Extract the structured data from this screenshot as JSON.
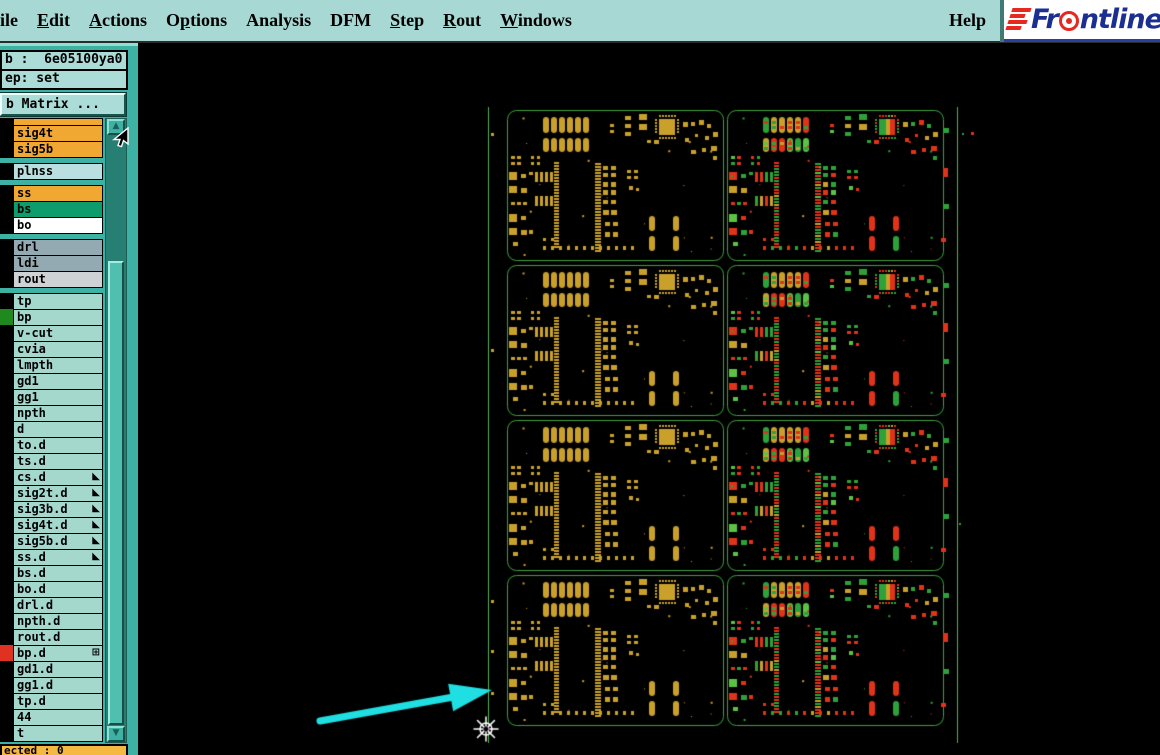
{
  "menubar": {
    "items": [
      {
        "label": "ile",
        "u": -1
      },
      {
        "label": "Edit",
        "u": 0
      },
      {
        "label": "Actions",
        "u": 0
      },
      {
        "label": "Options",
        "u": 1
      },
      {
        "label": "Analysis",
        "u": -1
      },
      {
        "label": "DFM",
        "u": -1
      },
      {
        "label": "Step",
        "u": 0
      },
      {
        "label": "Rout",
        "u": 0
      },
      {
        "label": "Windows",
        "u": 0
      }
    ],
    "help": {
      "label": "Help"
    },
    "logo": {
      "prefix": "Fr",
      "suffix": "ntline",
      "text_color": "#1b2f91",
      "accent_color": "#e8281e",
      "bar_count": 4
    }
  },
  "sidebar": {
    "job_label": "b :  6e05100ya0",
    "step_label": "ep: set",
    "matrix_button_label": "b Matrix ...",
    "selected_label": "ected : 0",
    "layers": [
      {
        "name": "",
        "bg": "#f0a832",
        "partial": true
      },
      {
        "name": "sig4t",
        "bg": "#f0a832"
      },
      {
        "name": "sig5b",
        "bg": "#f0a832"
      },
      {
        "name": "plnss",
        "bg": "#b9dfe0",
        "gap": true
      },
      {
        "name": "ss",
        "bg": "#f0a832",
        "gap": true
      },
      {
        "name": "bs",
        "bg": "#0d9d6d"
      },
      {
        "name": "bo",
        "bg": "#ffffff"
      },
      {
        "name": "drl",
        "bg": "#94aab2",
        "gap": true
      },
      {
        "name": "ldi",
        "bg": "#94aab2"
      },
      {
        "name": "rout",
        "bg": "#cfd2d4"
      },
      {
        "name": "tp",
        "bg": "#a5d8cd",
        "gap": true
      },
      {
        "name": "bp",
        "bg": "#a5d8cd",
        "swatch": "#1e8a1e"
      },
      {
        "name": "v-cut",
        "bg": "#a5d8cd"
      },
      {
        "name": "cvia",
        "bg": "#a5d8cd"
      },
      {
        "name": "lmpth",
        "bg": "#a5d8cd"
      },
      {
        "name": "gd1",
        "bg": "#a5d8cd"
      },
      {
        "name": "gg1",
        "bg": "#a5d8cd"
      },
      {
        "name": "npth",
        "bg": "#a5d8cd"
      },
      {
        "name": "d",
        "bg": "#a5d8cd"
      },
      {
        "name": "to.d",
        "bg": "#a5d8cd"
      },
      {
        "name": "ts.d",
        "bg": "#a5d8cd"
      },
      {
        "name": "cs.d",
        "bg": "#a5d8cd",
        "marker": "flag"
      },
      {
        "name": "sig2t.d",
        "bg": "#a5d8cd",
        "marker": "flag"
      },
      {
        "name": "sig3b.d",
        "bg": "#a5d8cd",
        "marker": "flag"
      },
      {
        "name": "sig4t.d",
        "bg": "#a5d8cd",
        "marker": "flag"
      },
      {
        "name": "sig5b.d",
        "bg": "#a5d8cd",
        "marker": "flag"
      },
      {
        "name": "ss.d",
        "bg": "#a5d8cd",
        "marker": "flag"
      },
      {
        "name": "bs.d",
        "bg": "#a5d8cd"
      },
      {
        "name": "bo.d",
        "bg": "#a5d8cd"
      },
      {
        "name": "drl.d",
        "bg": "#a5d8cd"
      },
      {
        "name": "npth.d",
        "bg": "#a5d8cd"
      },
      {
        "name": "rout.d",
        "bg": "#a5d8cd"
      },
      {
        "name": "bp.d",
        "bg": "#a5d8cd",
        "swatch": "#e03222",
        "marker": "grid"
      },
      {
        "name": "gd1.d",
        "bg": "#a5d8cd"
      },
      {
        "name": "gg1.d",
        "bg": "#a5d8cd"
      },
      {
        "name": "tp.d",
        "bg": "#a5d8cd"
      },
      {
        "name": "44",
        "bg": "#a5d8cd"
      },
      {
        "name": "t",
        "bg": "#a5d8cd"
      }
    ]
  },
  "icons": {
    "flag": "◣",
    "grid": "⊞",
    "scroll_up": "▲",
    "scroll_down": "▼"
  },
  "workspace": {
    "bg": "#000000",
    "panel": {
      "left_x": 350,
      "right_x": 819,
      "top_y": 64,
      "bottom_y": 700,
      "line_color": "#55b055",
      "fiducial_color": "#c8a02a",
      "fiducial_ys": [
        90,
        306,
        557,
        607,
        649
      ]
    },
    "grid": {
      "xs": [
        369,
        589
      ],
      "y0": 67,
      "rows": 4,
      "board_w": 216,
      "board_h": 150,
      "row_gap": 5,
      "outline_color": "#3fa23f"
    },
    "palette": {
      "yellow": "#c8a02a",
      "red": "#e03318",
      "green": "#2da23a",
      "green2": "#5cc244"
    },
    "arrow": {
      "x1": 182,
      "y1": 678,
      "x2": 354,
      "y2": 647,
      "color": "#1fdfe2",
      "width": 7
    },
    "crosshair": {
      "x": 348,
      "y": 686,
      "color": "#ffffff",
      "accent": "#d05ae0"
    }
  }
}
